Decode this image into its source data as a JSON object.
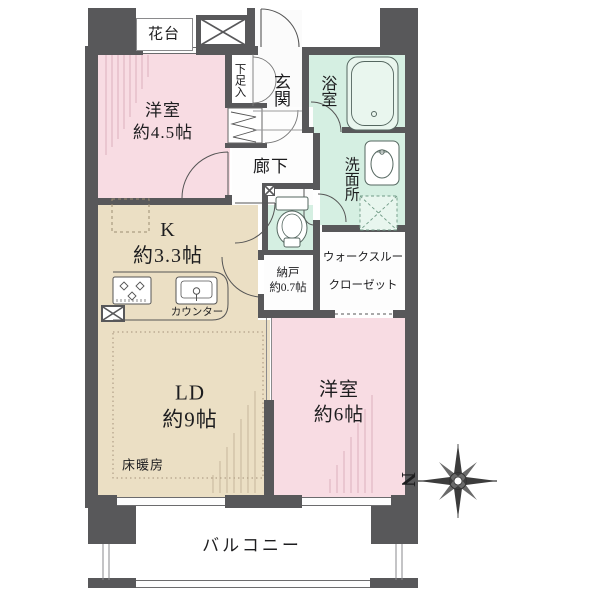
{
  "colors": {
    "wall": "#58585a",
    "bedroom_pink": "#f8dce3",
    "kitchen_tan": "#ebdfc4",
    "wet_mint": "#d5efe2",
    "white_floor": "#ffffff",
    "line": "#555555"
  },
  "compass": {
    "north_label": "N"
  },
  "rooms": {
    "flower_stand": {
      "label": "花台"
    },
    "bedroom45": {
      "label": "洋室",
      "size": "約4.5帖"
    },
    "shoe_box": {
      "label": "下足入"
    },
    "entrance": {
      "label": "玄関"
    },
    "bath": {
      "label": "浴室"
    },
    "corridor": {
      "label": "廊下"
    },
    "washroom": {
      "label": "洗面所"
    },
    "kitchen": {
      "label": "K",
      "size": "約3.3帖",
      "counter": "カウンター"
    },
    "storage": {
      "label": "納戸",
      "size": "約0.7帖"
    },
    "walk_through_closet": {
      "line1": "ウォークスルー",
      "line2": "クローゼット"
    },
    "living_dining": {
      "label": "LD",
      "size": "約9帖",
      "floor_heating": "床暖房"
    },
    "bedroom6": {
      "label": "洋室",
      "size": "約6帖"
    },
    "balcony": {
      "label": "バルコニー"
    }
  },
  "fixtures": {
    "bathtub": "bathtub-icon",
    "washbasin": "washbasin-icon",
    "toilet": "toilet-icon",
    "stove": "stove-icon",
    "kitchen_sink": "kitchen-sink-icon",
    "refrigerator_space": "refrigerator-space-dashed",
    "washer_space": "washer-space-dashed",
    "pipe_shaft": "pipe-shaft-x",
    "shoe_closet_hanger": "zigzag-hanger"
  }
}
